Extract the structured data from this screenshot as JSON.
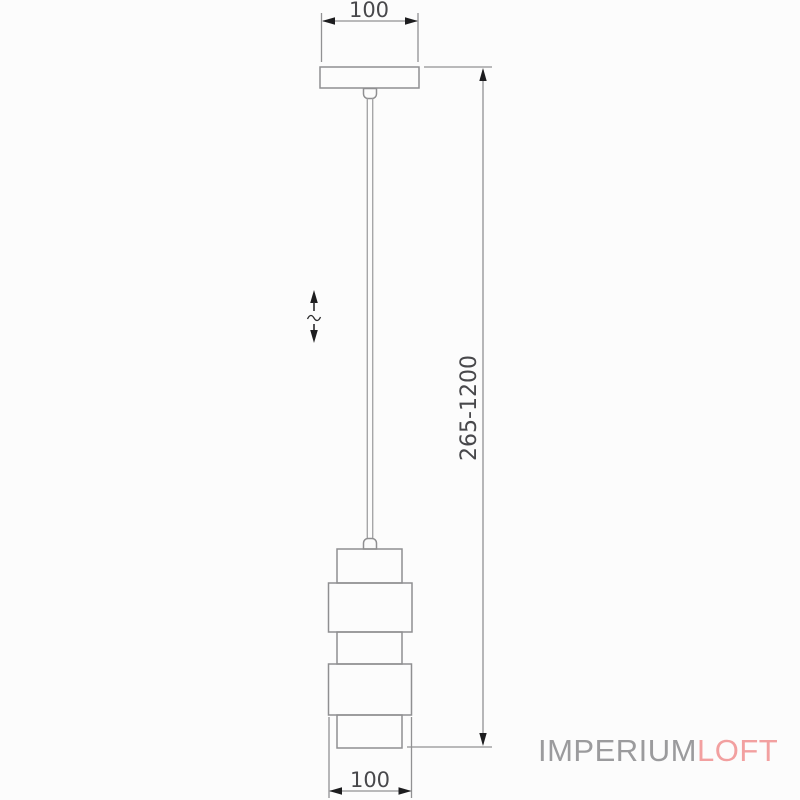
{
  "drawing": {
    "canopy_width_label": "100",
    "shade_diameter_label": "100",
    "suspension_height_label": "265-1200"
  },
  "watermark": {
    "text_primary": "IMPERIUM",
    "text_accent": "LOFT",
    "primary_color": "#9b9b9d",
    "accent_color": "#f2a0a0"
  },
  "colors": {
    "background": "#fcfcfc",
    "outline": "#8f8f91",
    "dimension_line": "#919193",
    "dimension_text": "#48484b",
    "arrowhead": "#1d1d1f"
  }
}
